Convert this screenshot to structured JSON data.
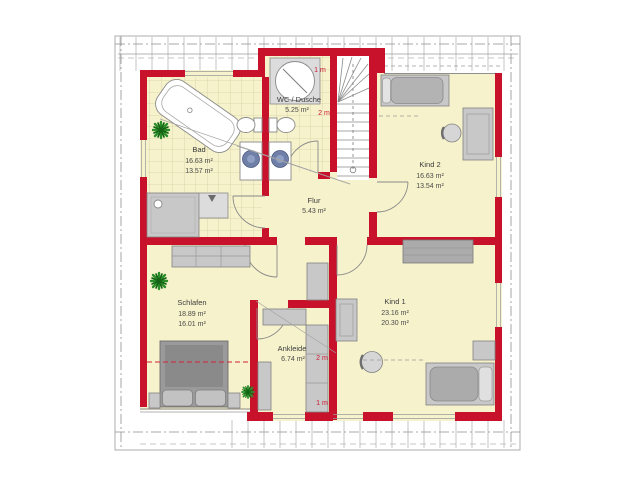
{
  "plan": {
    "rooms": {
      "bad": {
        "name": "Bad",
        "area_gross": "16.63 m²",
        "area_net": "13.57 m²"
      },
      "wc_dusche": {
        "name": "WC / Dusche",
        "area_gross": "5.25 m²"
      },
      "kind2": {
        "name": "Kind 2",
        "area_gross": "16.63 m²",
        "area_net": "13.54 m²"
      },
      "flur": {
        "name": "Flur",
        "area_gross": "5.43 m²"
      },
      "schlafen": {
        "name": "Schlafen",
        "area_gross": "18.89 m²",
        "area_net": "16.01 m²"
      },
      "ankleide": {
        "name": "Ankleide",
        "area_gross": "6.74 m²"
      },
      "kind1": {
        "name": "Kind 1",
        "area_gross": "23.16 m²",
        "area_net": "20.30 m²"
      }
    },
    "height_markers": {
      "north_1m": "1 m",
      "north_2m": "2 m",
      "south_2m": "2 m",
      "south_1m": "1 m"
    },
    "colors": {
      "wall": "#c8112b",
      "floor": "#f6f2cb",
      "tile_line": "#d6d1a4",
      "furniture": "#c8c8c8",
      "sink": "#6f7fa8",
      "plant": "#1f7d1f",
      "marker_text": "#cf1733",
      "label_text": "#3c3c3c"
    }
  }
}
